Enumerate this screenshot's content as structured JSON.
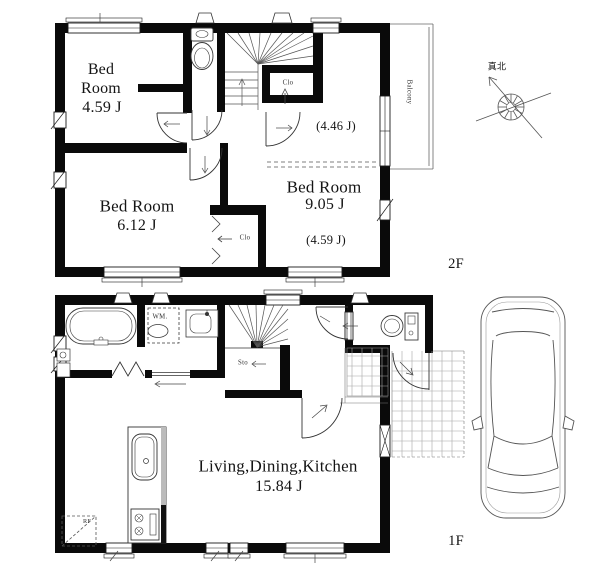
{
  "floor2": {
    "label": "2F",
    "bedroom_small": {
      "line1": "Bed",
      "line2": "Room",
      "area": "4.59 J"
    },
    "bedroom_left": {
      "name": "Bed Room",
      "area": "6.12 J"
    },
    "bedroom_right": {
      "name": "Bed Room",
      "area": "9.05 J",
      "upper_area": "(4.46 J)",
      "lower_area": "(4.59 J)"
    },
    "closet_upper": "Clo",
    "closet_lower": "Clo",
    "balcony": "Balcony"
  },
  "floor1": {
    "label": "1F",
    "ldk": {
      "name": "Living,Dining,Kitchen",
      "area": "15.84 J"
    },
    "storage": "Sto",
    "washing_machine": "WM.",
    "refrigerator": "RF"
  },
  "compass": {
    "true_north": "真北"
  },
  "colors": {
    "wall": "#000000",
    "background": "#ffffff",
    "line": "#333333"
  }
}
